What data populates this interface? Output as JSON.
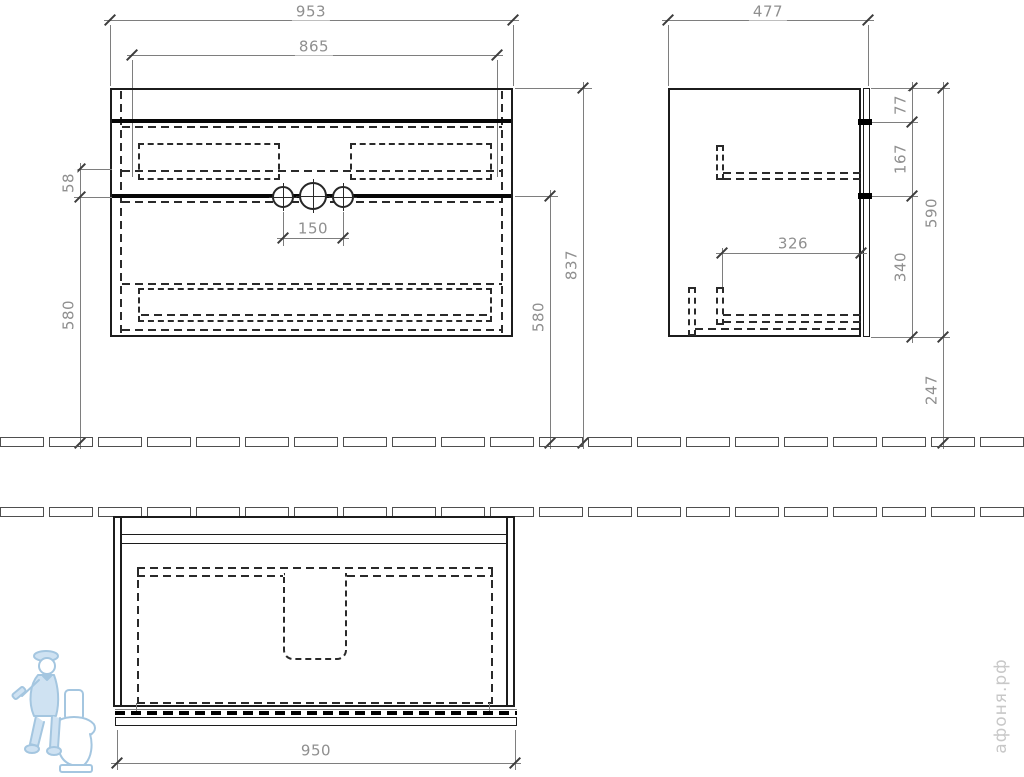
{
  "drawing": {
    "watermark_text": "афоня.рф",
    "dims": {
      "front_overall_width": "953",
      "front_inner_width": "865",
      "front_tap_spacing": "150",
      "front_apron_height": "58",
      "front_left_underside_height": "580",
      "front_right_underside_height": "580",
      "front_total_height": "837",
      "side_depth": "477",
      "side_top_thickness": "77",
      "side_upper_drawer_height": "167",
      "side_lower_drawer_height": "340",
      "side_drawer_depth": "326",
      "side_cabinet_height": "590",
      "side_floor_clearance": "247",
      "plan_width": "950"
    },
    "colors": {
      "outline": "#1c1c1c",
      "dimension_text": "#8f8f8f",
      "watermark_blue": "#b9d5ea",
      "watermark_gray": "#c8c8c8"
    }
  }
}
